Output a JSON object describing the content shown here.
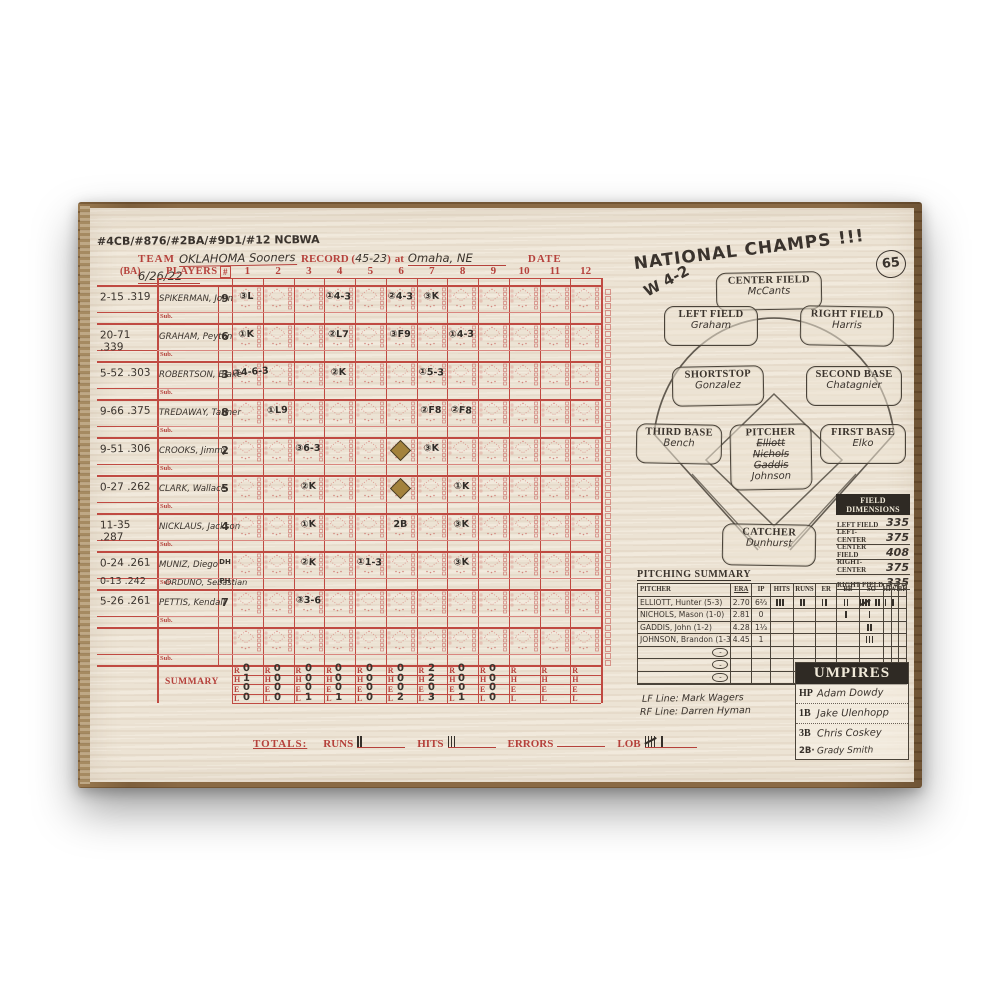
{
  "annotations": {
    "memorabilia_line": "#4CB/#876/#2BA/#9D1/#12 NCBWA",
    "national_champs": "NATIONAL CHAMPS !!!",
    "score_note": "W 4-2",
    "page_number": "65"
  },
  "header": {
    "team_label": "TEAM",
    "team_value": "OKLAHOMA Sooners",
    "record_label": "RECORD (",
    "record_value": "45-23",
    "record_close": ")",
    "at_label": "at",
    "location_value": "Omaha, NE",
    "date_label": "DATE",
    "date_value": "6/26/22"
  },
  "grid": {
    "ba_label": "(BA)",
    "players_label": "PLAYERS",
    "pos_label": "#",
    "sub_label": "Sub.",
    "summary_label": "SUMMARY",
    "innings": [
      "1",
      "2",
      "3",
      "4",
      "5",
      "6",
      "7",
      "8",
      "9",
      "10",
      "11",
      "12"
    ],
    "players": [
      {
        "stat": "2-15",
        "avg": ".319",
        "name": "SPIKERMAN, John",
        "pos": "9",
        "sub_name": "",
        "sub_stat": "",
        "sub_avg": "",
        "sub_pos": ""
      },
      {
        "stat": "20-71",
        "avg": ".339",
        "name": "GRAHAM, Peyton",
        "pos": "6",
        "sub_name": "",
        "sub_stat": "",
        "sub_avg": "",
        "sub_pos": ""
      },
      {
        "stat": "5-52",
        "avg": ".303",
        "name": "ROBERTSON, Blake",
        "pos": "3",
        "sub_name": "",
        "sub_stat": "",
        "sub_avg": "",
        "sub_pos": ""
      },
      {
        "stat": "9-66",
        "avg": ".375",
        "name": "TREDAWAY, Tanner",
        "pos": "8",
        "sub_name": "",
        "sub_stat": "",
        "sub_avg": "",
        "sub_pos": ""
      },
      {
        "stat": "9-51",
        "avg": ".306",
        "name": "CROOKS, Jimmy",
        "pos": "2",
        "sub_name": "",
        "sub_stat": "",
        "sub_avg": "",
        "sub_pos": ""
      },
      {
        "stat": "0-27",
        "avg": ".262",
        "name": "CLARK, Wallace",
        "pos": "5",
        "sub_name": "",
        "sub_stat": "",
        "sub_avg": "",
        "sub_pos": ""
      },
      {
        "stat": "11-35",
        "avg": ".287",
        "name": "NICKLAUS, Jackson",
        "pos": "4",
        "sub_name": "",
        "sub_stat": "",
        "sub_avg": "",
        "sub_pos": ""
      },
      {
        "stat": "0-24",
        "avg": ".261",
        "name": "MUNIZ, Diego",
        "pos": "DH",
        "sub_name": "ORDUNO, Sebastian",
        "sub_stat": "0-13",
        "sub_avg": ".242",
        "sub_pos": "PH"
      },
      {
        "stat": "5-26",
        "avg": ".261",
        "name": "PETTIS, Kendall",
        "pos": "7",
        "sub_name": "",
        "sub_stat": "",
        "sub_avg": "",
        "sub_pos": ""
      },
      {
        "stat": "",
        "avg": "",
        "name": "",
        "pos": "",
        "sub_name": "",
        "sub_stat": "",
        "sub_avg": "",
        "sub_pos": ""
      }
    ],
    "marks": [
      {
        "row": 0,
        "inning": 1,
        "text": "③L"
      },
      {
        "row": 0,
        "inning": 4,
        "text": "①4-3"
      },
      {
        "row": 0,
        "inning": 6,
        "text": "②4-3"
      },
      {
        "row": 0,
        "inning": 7,
        "text": "③K"
      },
      {
        "row": 1,
        "inning": 1,
        "text": "①K"
      },
      {
        "row": 1,
        "inning": 4,
        "text": "②L7"
      },
      {
        "row": 1,
        "inning": 6,
        "text": "③F9"
      },
      {
        "row": 1,
        "inning": 8,
        "text": "①4-3"
      },
      {
        "row": 2,
        "inning": 1,
        "text": "③4-6-3"
      },
      {
        "row": 2,
        "inning": 4,
        "text": "②K"
      },
      {
        "row": 2,
        "inning": 7,
        "text": "①5-3"
      },
      {
        "row": 3,
        "inning": 2,
        "text": "①L9"
      },
      {
        "row": 3,
        "inning": 7,
        "text": "②F8"
      },
      {
        "row": 3,
        "inning": 8,
        "text": "②F8"
      },
      {
        "row": 4,
        "inning": 3,
        "text": "③6-3"
      },
      {
        "row": 4,
        "inning": 7,
        "text": "③K"
      },
      {
        "row": 5,
        "inning": 3,
        "text": "②K"
      },
      {
        "row": 5,
        "inning": 8,
        "text": "①K"
      },
      {
        "row": 6,
        "inning": 3,
        "text": "①K"
      },
      {
        "row": 6,
        "inning": 6,
        "text": "2B"
      },
      {
        "row": 6,
        "inning": 8,
        "text": "③K"
      },
      {
        "row": 7,
        "inning": 3,
        "text": "②K"
      },
      {
        "row": 7,
        "inning": 5,
        "text": "①1-3"
      },
      {
        "row": 7,
        "inning": 8,
        "text": "③K"
      },
      {
        "row": 8,
        "inning": 3,
        "text": "③3-6"
      }
    ],
    "run_diamonds": [
      {
        "row": 4,
        "inning": 6
      },
      {
        "row": 5,
        "inning": 6
      }
    ],
    "summary_rows": [
      {
        "letter": "R",
        "values": [
          "0",
          "0",
          "0",
          "0",
          "0",
          "0",
          "2",
          "0",
          "0",
          "",
          "",
          ""
        ]
      },
      {
        "letter": "H",
        "values": [
          "1",
          "0",
          "0",
          "0",
          "0",
          "0",
          "2",
          "0",
          "0",
          "",
          "",
          ""
        ]
      },
      {
        "letter": "E",
        "values": [
          "0",
          "0",
          "0",
          "0",
          "0",
          "0",
          "0",
          "0",
          "0",
          "",
          "",
          ""
        ]
      },
      {
        "letter": "L",
        "values": [
          "0",
          "0",
          "1",
          "1",
          "0",
          "2",
          "3",
          "1",
          "0",
          "",
          "",
          ""
        ]
      }
    ]
  },
  "totals": {
    "label": "TOTALS:",
    "runs_label": "RUNS",
    "runs": 2,
    "hits_label": "HITS",
    "hits": 3,
    "errors_label": "ERRORS",
    "errors": 0,
    "lob_label": "LOB",
    "lob": 6
  },
  "field": {
    "positions": [
      {
        "label": "CENTER FIELD",
        "names": [
          "McCants"
        ],
        "struck": [
          false
        ]
      },
      {
        "label": "LEFT FIELD",
        "names": [
          "Graham"
        ],
        "struck": [
          false
        ]
      },
      {
        "label": "RIGHT FIELD",
        "names": [
          "Harris"
        ],
        "struck": [
          false
        ]
      },
      {
        "label": "SHORTSTOP",
        "names": [
          "Gonzalez"
        ],
        "struck": [
          false
        ]
      },
      {
        "label": "SECOND BASE",
        "names": [
          "Chatagnier"
        ],
        "struck": [
          false
        ]
      },
      {
        "label": "THIRD BASE",
        "names": [
          "Bench"
        ],
        "struck": [
          false
        ]
      },
      {
        "label": "PITCHER",
        "names": [
          "Elliott",
          "Nichols",
          "Gaddis",
          "Johnson"
        ],
        "struck": [
          true,
          true,
          true,
          false
        ]
      },
      {
        "label": "FIRST BASE",
        "names": [
          "Elko"
        ],
        "struck": [
          false
        ]
      },
      {
        "label": "CATCHER",
        "names": [
          "Dunhurst"
        ],
        "struck": [
          false
        ]
      }
    ]
  },
  "field_dimensions": {
    "title": "FIELD DIMENSIONS",
    "rows": [
      {
        "label": "LEFT FIELD",
        "value": "335"
      },
      {
        "label": "LEFT-CENTER",
        "value": "375"
      },
      {
        "label": "CENTER FIELD",
        "value": "408"
      },
      {
        "label": "RIGHT-CENTER",
        "value": "375"
      },
      {
        "label": "RIGHT FIELD",
        "value": "335"
      }
    ]
  },
  "pitching_summary": {
    "title": "PITCHING SUMMARY",
    "columns": [
      "PITCHER",
      "ERA",
      "IP",
      "HITS",
      "RUNS",
      "ER",
      "BB",
      "SO",
      "HP",
      "WP",
      "BK"
    ],
    "rows": [
      {
        "pitcher": "ELLIOTT, Hunter (5-3)",
        "era": "2.70",
        "ip": "6⅔",
        "hits": 3,
        "runs": 2,
        "er": 2,
        "bb": 2,
        "so": 7,
        "hp": 1,
        "wp": 1,
        "bk": 0
      },
      {
        "pitcher": "NICHOLS, Mason (1-0)",
        "era": "2.81",
        "ip": "0",
        "hits": 0,
        "runs": 0,
        "er": 0,
        "bb": 1,
        "so": 1,
        "hp": 0,
        "wp": 0,
        "bk": 0
      },
      {
        "pitcher": "GADDIS, John (1-2)",
        "era": "4.28",
        "ip": "1⅓",
        "hits": 0,
        "runs": 0,
        "er": 0,
        "bb": 0,
        "so": 2,
        "hp": 0,
        "wp": 0,
        "bk": 0
      },
      {
        "pitcher": "JOHNSON, Brandon (1-3)",
        "era": "4.45",
        "ip": "1",
        "hits": 0,
        "runs": 0,
        "er": 0,
        "bb": 0,
        "so": 3,
        "hp": 0,
        "wp": 0,
        "bk": 0
      },
      {
        "pitcher": "",
        "era": "",
        "ip": "",
        "hits": 0,
        "runs": 0,
        "er": 0,
        "bb": 0,
        "so": 0,
        "hp": 0,
        "wp": 0,
        "bk": 0
      },
      {
        "pitcher": "",
        "era": "",
        "ip": "",
        "hits": 0,
        "runs": 0,
        "er": 0,
        "bb": 0,
        "so": 0,
        "hp": 0,
        "wp": 0,
        "bk": 0
      },
      {
        "pitcher": "",
        "era": "",
        "ip": "",
        "hits": 0,
        "runs": 0,
        "er": 0,
        "bb": 0,
        "so": 0,
        "hp": 0,
        "wp": 0,
        "bk": 0
      }
    ]
  },
  "line_umpires": {
    "lf": "LF Line: Mark Wagers",
    "rf": "RF Line: Darren Hyman"
  },
  "umpires": {
    "title": "UMPIRES",
    "rows": [
      {
        "pos": "HP",
        "name": "Adam Dowdy",
        "hw_pos": false
      },
      {
        "pos": "1B",
        "name": "Jake Ulenhopp",
        "hw_pos": false
      },
      {
        "pos": "3B",
        "name": "Chris Coskey",
        "hw_pos": false
      },
      {
        "pos": "2B·",
        "name": "Grady Smith",
        "hw_pos": true
      }
    ]
  }
}
